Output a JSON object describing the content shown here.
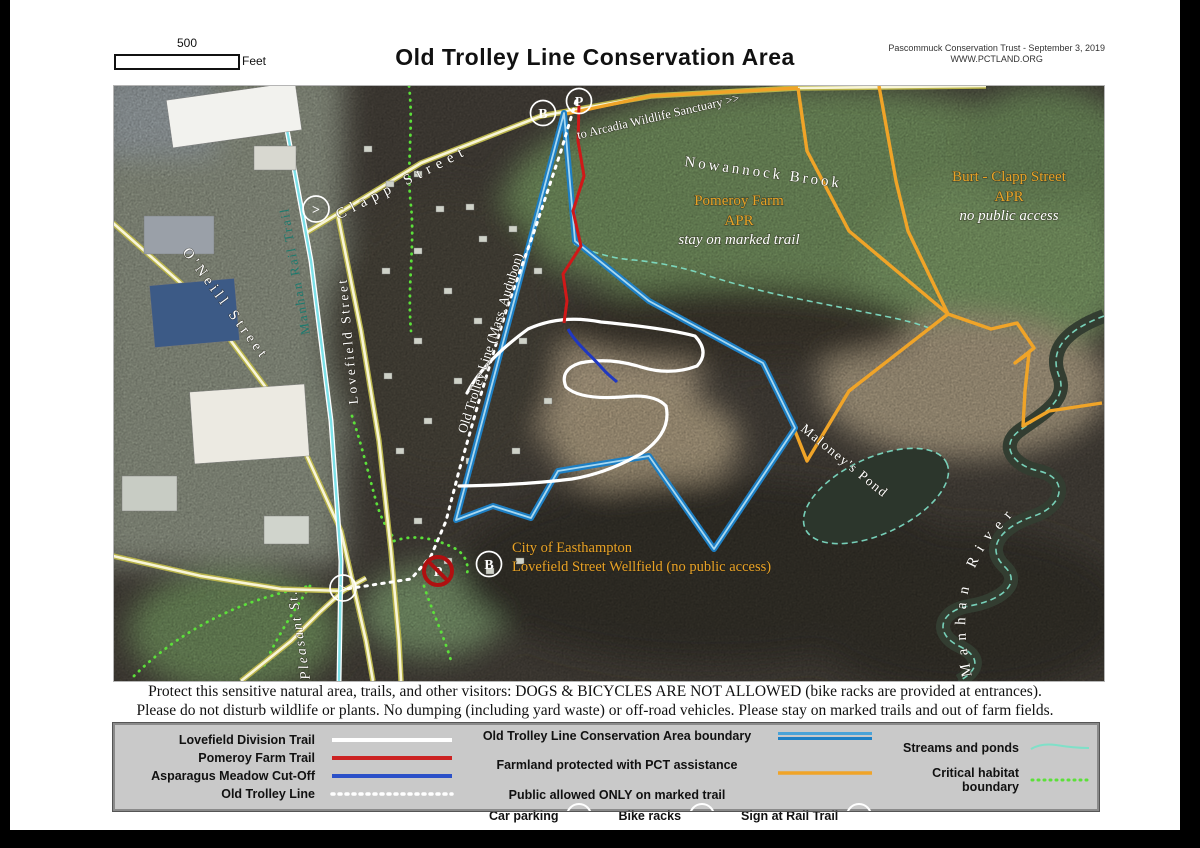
{
  "header": {
    "scale_value": "500",
    "scale_unit": "Feet",
    "title": "Old Trolley Line Conservation Area",
    "credit_line1": "Pascommuck Conservation Trust - September 3, 2019",
    "credit_line2": "WWW.PCTLAND.ORG"
  },
  "map": {
    "labels": {
      "to_arcadia": "to Arcadia Wildlife Sanctuary >>",
      "nowannock_brook": "Nowannock Brook",
      "clapp_street": "Clapp Street",
      "oneill_street": "O'Neill Street",
      "manhan_rail_trail": "Manhan Rail Trail",
      "lovefield_street": "Lovefield Street",
      "pleasant_st": "Pleasant St.",
      "old_trolley_line": "Old Trolley Line (Mass. Audubon)",
      "pomeroy_farm": "Pomeroy Farm",
      "pomeroy_apr": "APR",
      "pomeroy_note": "stay on marked trail",
      "burt_clapp": "Burt - Clapp Street",
      "burt_apr": "APR",
      "burt_note": "no public access",
      "city_line1": "City of Easthampton",
      "city_line2": "Lovefield Street Wellfield  (no public access)",
      "maloneys_pond": "Maloney's Pond",
      "manhan_river": "Manhan River"
    },
    "markers": {
      "parking": "P",
      "bike": "B",
      "sign": ">"
    }
  },
  "notice": {
    "line1": "Protect this sensitive natural area, trails, and other visitors:  DOGS &  BICYCLES ARE NOT ALLOWED (bike racks are provided at entrances).",
    "line2": "Please do not disturb wildlife or plants.  No dumping (including yard waste) or off-road vehicles.  Please stay on marked trails and out of farm fields."
  },
  "legend": {
    "trails": [
      {
        "label": "Lovefield Division Trail"
      },
      {
        "label": "Pomeroy Farm Trail"
      },
      {
        "label": "Asparagus Meadow Cut-Off"
      },
      {
        "label": "Old Trolley Line"
      }
    ],
    "boundary_label": "Old Trolley Line Conservation Area boundary",
    "farmland_label1": "Farmland protected with PCT assistance",
    "farmland_label2": "Public allowed ONLY on marked trail",
    "car_parking": "Car parking",
    "bike_racks": "Bike racks",
    "sign_rail": "Sign at Rail Trail",
    "streams": "Streams and ponds",
    "habitat": "Critical habitat boundary",
    "marker_p": "P",
    "marker_b": "B",
    "marker_gt": ">"
  },
  "colors": {
    "boundary_blue": "#1d7fc4",
    "farmland_orange": "#f0a428",
    "trail_red": "#cc2222",
    "cutoff_blue": "#2b50c8",
    "habitat_green": "#5ce03a",
    "stream_teal": "#7fe0c8",
    "label_orange": "#e8a226"
  }
}
